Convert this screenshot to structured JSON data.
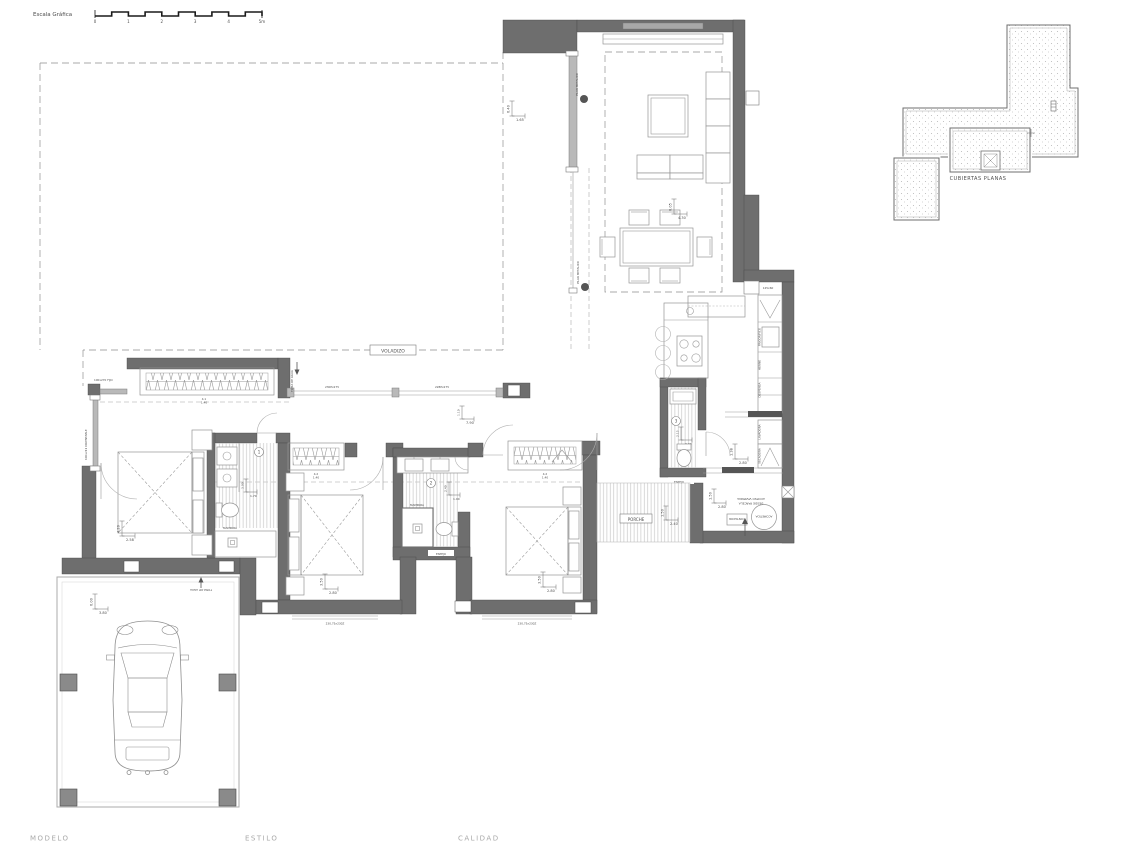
{
  "scale_bar": {
    "label": "Escala Gráfica",
    "ticks": [
      "0",
      "1",
      "2",
      "3",
      "4",
      "5m"
    ]
  },
  "roof_inset": {
    "label": "CUBIERTAS PLANAS"
  },
  "footer": {
    "labels": [
      "MODELO",
      "ESTILO",
      "CALIDAD"
    ]
  },
  "plan": {
    "annotations": {
      "voladizo": "VOLADIZO",
      "porche": "PORCHE",
      "pilar": "PILAR METALICO",
      "toma_agua": "TOMA DE AGUA",
      "mampara": "MAMPARA",
      "espejo": "ESPEJO",
      "acometida": "ACOMETIDA",
      "contador": "CONTADOR",
      "acceso_line1": "ACCESO VIVIENDA",
      "acceso_line2": "DESDE PARCELA",
      "room_numbers": [
        "1",
        "2",
        "3"
      ]
    },
    "windows": {
      "fijo": "100x270 FIJO",
      "orientable": "100x211 ORIENTABLE",
      "hall_1": "230Px275",
      "hall_2": "228Px275",
      "south": "230,75x230Z",
      "niche": "125x60",
      "wardrobe_1": [
        "4.1",
        "1.40"
      ],
      "wardrobe_2": [
        "4.2",
        "1.40"
      ],
      "wardrobe_3": [
        "4.2",
        "1.40"
      ]
    },
    "appliances": [
      "FRIGORIFICO",
      "HORNO",
      "DESPENSA",
      "LAVADORA",
      "SECADORA"
    ],
    "dims": {
      "living": {
        "v": "6.40",
        "h": "1.65"
      },
      "dining": {
        "v": "6.05",
        "h": "4.30"
      },
      "hall": {
        "v": "1.10",
        "h": "7.90"
      },
      "bed1": {
        "v": "4.20",
        "h": "2.58"
      },
      "bath1": {
        "v": "3.00",
        "h": "1.70"
      },
      "bed2": {
        "v": "3.50",
        "h": "2.80"
      },
      "bath2": {
        "v": "2.40",
        "h": "1.90"
      },
      "bath3": {
        "v": "2.15",
        "h": "0.90"
      },
      "bed3": {
        "v": "3.50",
        "h": "2.80"
      },
      "porch": {
        "v": "1.50",
        "h": "2.40"
      },
      "laundry": {
        "v": "1.38",
        "h": "2.80"
      },
      "entry": {
        "v": "1.50",
        "h": "2.80"
      },
      "garage": {
        "v": "6.00",
        "h": "3.80"
      }
    }
  }
}
